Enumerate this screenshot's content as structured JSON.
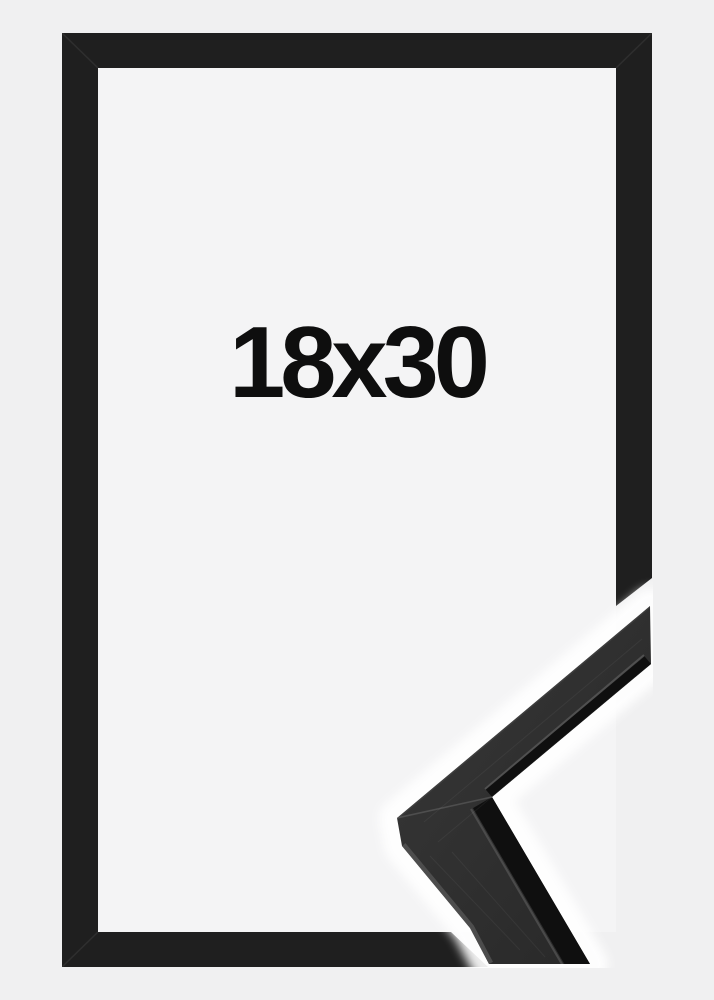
{
  "product_image": {
    "size_label": "18x30",
    "description": "black picture frame product photo with corner profile close-up",
    "colors": {
      "page_background": "#f0f0f1",
      "inner_background": "#f4f4f5",
      "frame_black": "#1f1f1f",
      "detail_face_light": "#383838",
      "detail_face_dark": "#272727",
      "detail_edge_dark": "#0f0f0f",
      "detail_white_backdrop": "#ffffff",
      "label_text": "#0e0e0e"
    }
  }
}
